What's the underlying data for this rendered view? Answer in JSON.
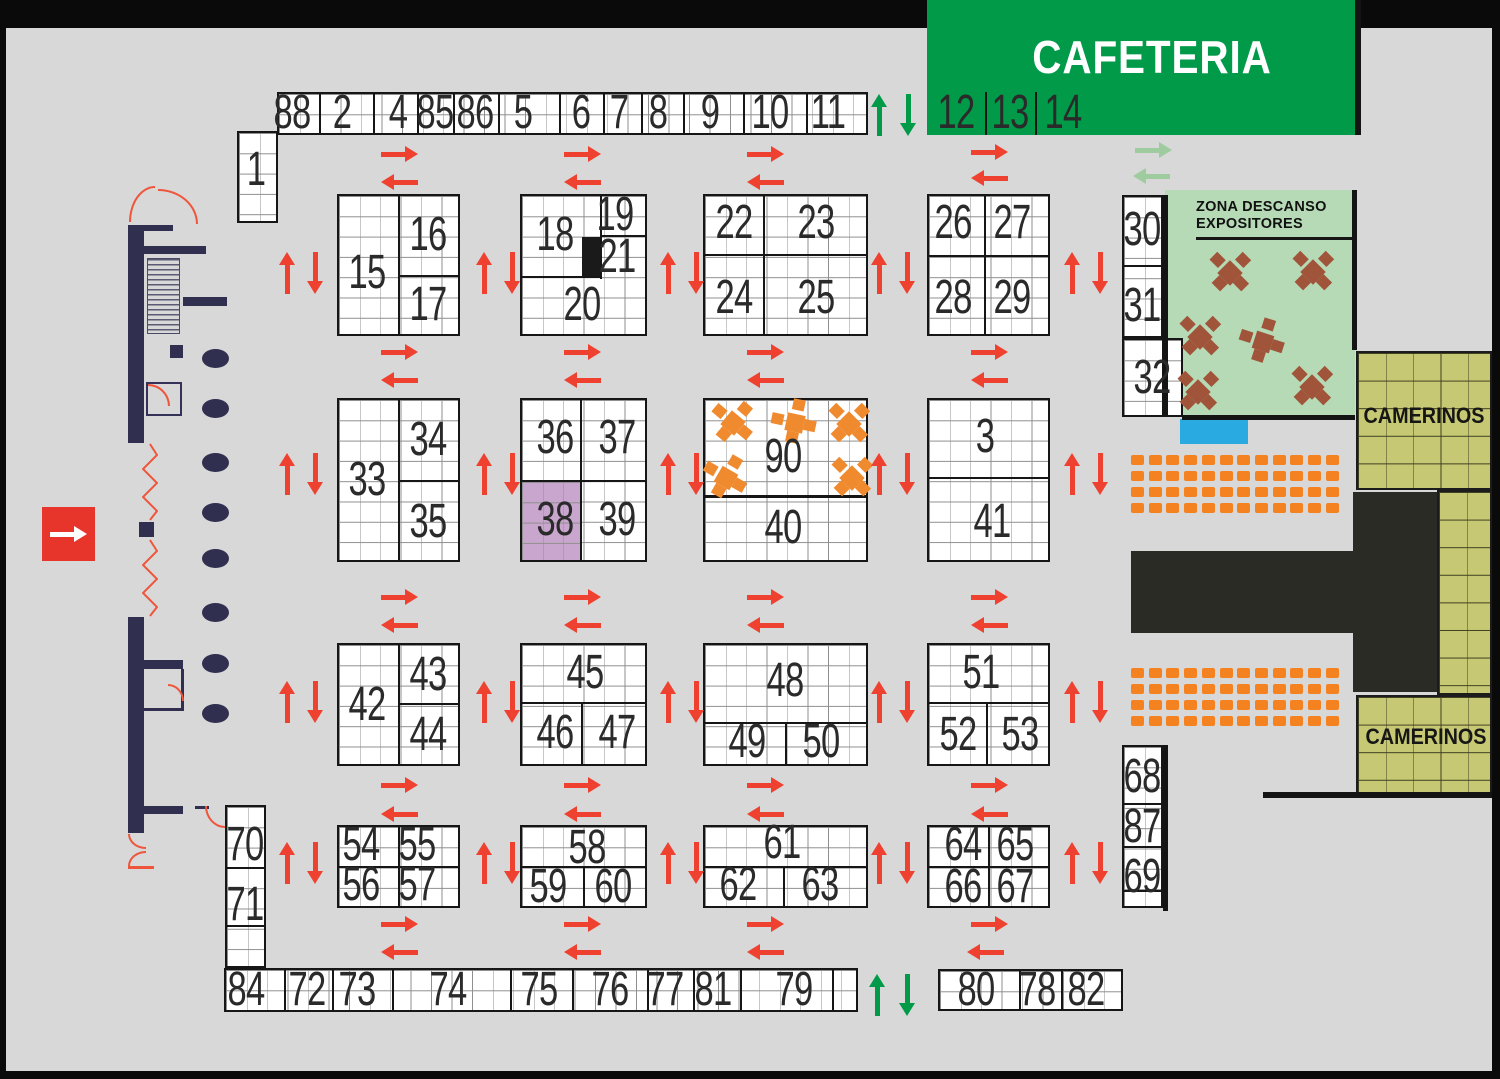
{
  "areas": {
    "cafeteria": "CAFETERIA",
    "camerinos_top": "CAMERINOS",
    "camerinos_bottom": "CAMERINOS",
    "zona_descanso_line1": "ZONA DESCANSO",
    "zona_descanso_line2": "EXPOSITORES"
  },
  "booths": {
    "1": "1",
    "2": "2",
    "3": "3",
    "4": "4",
    "5": "5",
    "6": "6",
    "7": "7",
    "8": "8",
    "9": "9",
    "10": "10",
    "11": "11",
    "12": "12",
    "13": "13",
    "14": "14",
    "15": "15",
    "16": "16",
    "17": "17",
    "18": "18",
    "19": "19",
    "20": "20",
    "21": "21",
    "22": "22",
    "23": "23",
    "24": "24",
    "25": "25",
    "26": "26",
    "27": "27",
    "28": "28",
    "29": "29",
    "30": "30",
    "31": "31",
    "32": "32",
    "33": "33",
    "34": "34",
    "35": "35",
    "36": "36",
    "37": "37",
    "38": "38",
    "39": "39",
    "40": "40",
    "41": "41",
    "42": "42",
    "43": "43",
    "44": "44",
    "45": "45",
    "46": "46",
    "47": "47",
    "48": "48",
    "49": "49",
    "50": "50",
    "51": "51",
    "52": "52",
    "53": "53",
    "54": "54",
    "55": "55",
    "56": "56",
    "57": "57",
    "58": "58",
    "59": "59",
    "60": "60",
    "61": "61",
    "62": "62",
    "63": "63",
    "64": "64",
    "65": "65",
    "66": "66",
    "67": "67",
    "68": "68",
    "69": "69",
    "70": "70",
    "71": "71",
    "72": "72",
    "73": "73",
    "74": "74",
    "75": "75",
    "76": "76",
    "77": "77",
    "78": "78",
    "79": "79",
    "80": "80",
    "81": "81",
    "82": "82",
    "84": "84",
    "85": "85",
    "86": "86",
    "87": "87",
    "88": "88",
    "90": "90"
  },
  "colors": {
    "floor": "#d8d8d8",
    "frame": "#0a0a0a",
    "booth_fill": "#ffffff",
    "grid_line": "#8f8f8f",
    "block_border": "#161616",
    "flow_arrow_red": "#ee4130",
    "entry_arrow_green": "#009a49",
    "cafeteria_arrow_pale_green": "#9fcc9f",
    "cafeteria_green": "#009a49",
    "zona_descanso_green": "#b6dab6",
    "camerinos_olive": "#c6c873",
    "highlight_purple": "#c9a6ce",
    "chair_orange": "#f58220",
    "table_orange": "#f08a2e",
    "table_brown": "#a0543a",
    "wall_navy": "#312f50",
    "pool_blue": "#29abe2",
    "stage_black": "#2b2b26",
    "entrance_red": "#e8352b",
    "reserved_black": "#1a1a1a"
  }
}
